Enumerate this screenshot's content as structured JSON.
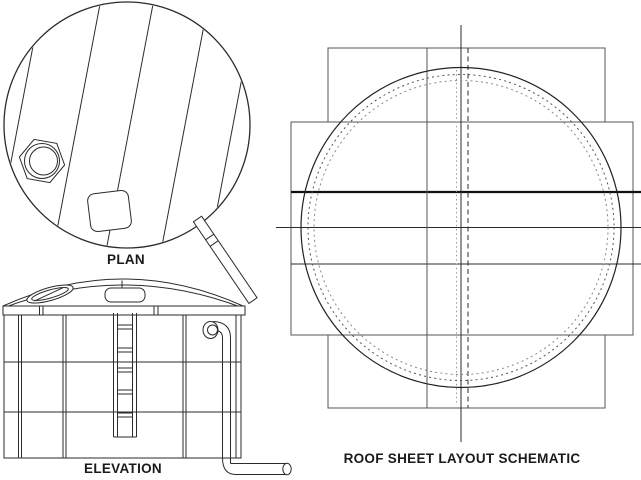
{
  "page": {
    "background": "#ffffff"
  },
  "views": {
    "plan": {
      "label": "PLAN"
    },
    "elevation": {
      "label": "ELEVATION"
    },
    "roof_schematic": {
      "label": "ROOF SHEET LAYOUT SCHEMATIC"
    }
  },
  "colors": {
    "line_dark": "#2b2b2b",
    "line_medium": "#555555",
    "line_light": "#999999",
    "line_heavy": "#111111",
    "text": "#1a1a1a",
    "background": "#ffffff"
  }
}
